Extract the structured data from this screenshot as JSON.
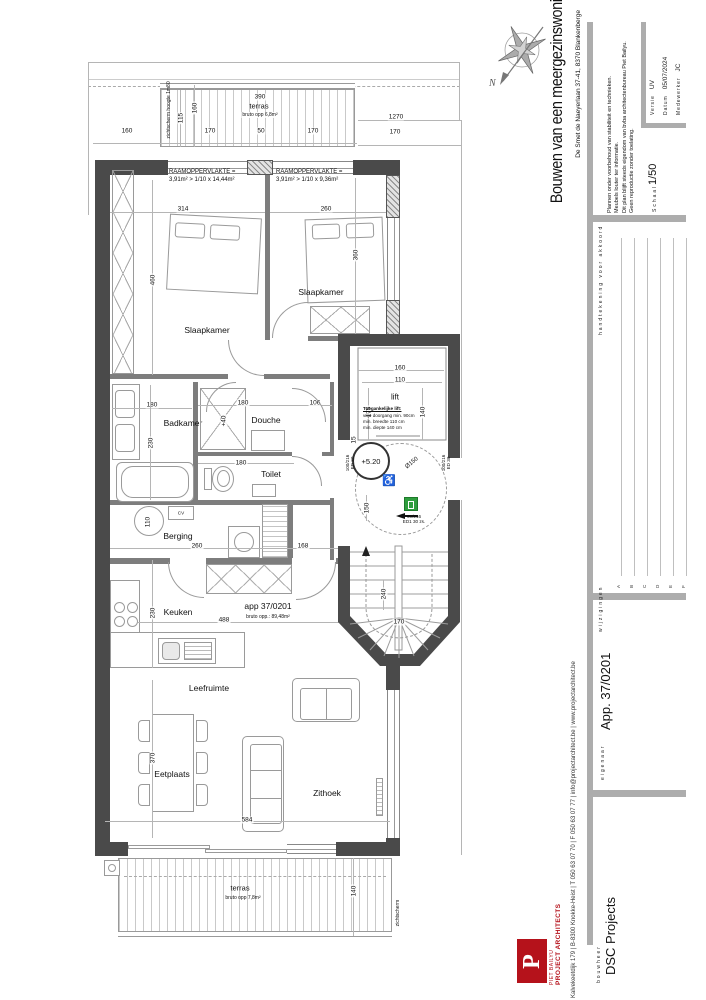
{
  "sheet": {
    "compass_label": "N"
  },
  "title_block": {
    "title": "Bouwen van een meergezinswoning",
    "address": "De Smet de Naeyerlaan 37-41, 8370 Blankenberge",
    "notes": {
      "line1": "Plannen onder voorbehoud van stabiliteit en technieken.",
      "line2": "Meubels louter ter informatie.",
      "line3": "Dit plan blijft steeds eigendom van bvba architectenbureau Piet Bailyu.",
      "line4": "Geen reproductie zonder toelating."
    },
    "fields": {
      "versie_label": "Versie",
      "versie_value": "UV",
      "datum_label": "Datum",
      "datum_value": "05/07/2024",
      "medewerker_label": "Medewerker",
      "medewerker_value": "JC",
      "schaal_label": "Schaal",
      "schaal_value": "1/50"
    },
    "signature_label": "handtekening voor akkoord",
    "revisions_label": "wijzigingen",
    "revisions": {
      "a": "A",
      "b": "B",
      "c": "C",
      "d": "D",
      "e": "E",
      "f": "F"
    },
    "eigenaar_label": "eigenaar",
    "eigenaar_value": "App. 37/0201",
    "bouwheer_label": "bouwheer",
    "bouwheer_value": "DSC Projects"
  },
  "firm": {
    "logo_letter": "P",
    "name_top": "PIET BAILYU",
    "name_bottom": "PROJECT ARCHITECTS",
    "contact": "Kalvekeetdijk 179   |   B-8300 Knokke-Heist   |   T 050 63 07 70   |   F 050 63 07 77   |   info@projectarchitect.be   |   www.projectarchitect.be"
  },
  "plan": {
    "apartment_label": "app 37/0201",
    "apartment_area": "bruto opp.: 89,48m²",
    "rooms": {
      "slaapkamer1": "Slaapkamer",
      "slaapkamer2": "Slaapkamer",
      "badkamer": "Badkamer",
      "douche": "Douche",
      "toilet": "Toilet",
      "berging": "Berging",
      "keuken": "Keuken",
      "leefruimte": "Leefruimte",
      "eetplaats": "Eetplaats",
      "zithoek": "Zithoek",
      "lift": "lift",
      "cv": "CV"
    },
    "terras_top": {
      "label": "terras",
      "area": "bruto opp 6,8m²",
      "screen": "zichtscherm hoogte 1m80"
    },
    "terras_bottom": {
      "label": "terras",
      "area": "bruto opp 7,8m²",
      "screen": "zichtscherm"
    },
    "raam_left": {
      "line1": "RAAMOPPERVLAKTE =",
      "line2": "3,91m² > 1/10 x 14,44m²"
    },
    "raam_right": {
      "line1": "RAAMOPPERVLAKTE =",
      "line2": "3,91m² > 1/10 x 9,36m²"
    },
    "lift_note": {
      "title": "Toegankelijke lift:",
      "line1": "vrije doorgang min. 90cm",
      "line2": "min. breedte 110 cm",
      "line3": "min. diepte 140 cm"
    },
    "level": "+5.20",
    "douche_level": "+40",
    "turning_circle": "Ø150",
    "door_left": {
      "line1": "100/216",
      "line2": "ED 30"
    },
    "door_right": {
      "line1": "100/216",
      "line2": "ED 30"
    },
    "door_bottom": {
      "line1": "90/216",
      "line2": "ED1 30 zs."
    },
    "dims": {
      "top_160": "160",
      "top_170a": "170",
      "top_50": "50",
      "top_170b": "170",
      "top_1270": "1270",
      "top_170r": "170",
      "terras_390": "390",
      "terras_115": "115",
      "terras_160": "160",
      "slk1_314": "314",
      "slk1_460": "460",
      "slk2_260": "260",
      "slk2_360": "360",
      "bad_180": "180",
      "bad_230": "230",
      "douche_180": "180",
      "douche_106": "106",
      "toilet_180": "180",
      "boiler_110": "110",
      "berging_260": "260",
      "berging_168": "168",
      "keuken_230": "230",
      "keuken_488": "488",
      "eet_370": "370",
      "leef_584": "584",
      "terras2_140": "140",
      "lift_160": "160",
      "lift_110": "110",
      "lift_175": "175",
      "lift_140": "140",
      "lift_15": "15",
      "hal_150": "150",
      "trap_240": "240",
      "trap_170": "170"
    }
  }
}
